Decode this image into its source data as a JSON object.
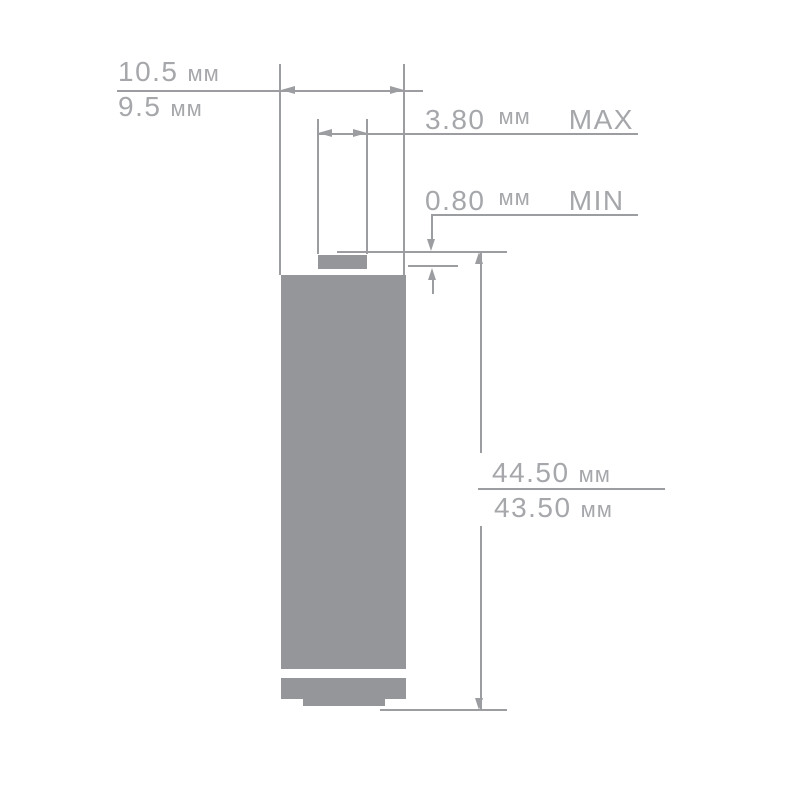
{
  "figure": {
    "unit": "мм",
    "dimensions": {
      "body_diameter": {
        "max": "10.5",
        "min": "9.5"
      },
      "tip_diameter": {
        "value": "3.80",
        "qualifier": "MAX"
      },
      "tip_height": {
        "value": "0.80",
        "qualifier": "MIN"
      },
      "overall_height": {
        "max": "44.50",
        "min": "43.50"
      }
    },
    "colors": {
      "battery_fill": "#95969a",
      "dimension_lines": "#9b9da0",
      "label_text": "#a5a7aa",
      "background": "#ffffff"
    }
  }
}
